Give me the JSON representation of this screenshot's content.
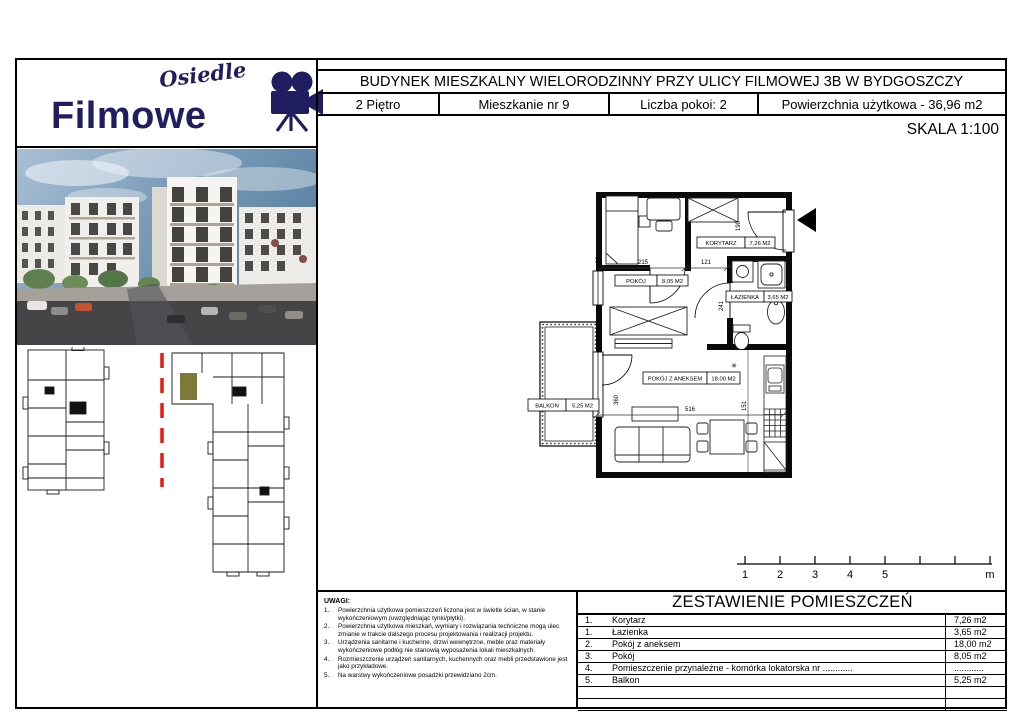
{
  "logo": {
    "top": "Osiedle",
    "bottom": "Filmowe"
  },
  "header": {
    "title": "BUDYNEK MIESZKALNY WIELORODZINNY PRZY ULICY FILMOWEJ 3B W BYDGOSZCZY",
    "floor": "2 Piętro",
    "apartment": "Mieszkanie nr 9",
    "rooms": "Liczba pokoi: 2",
    "area": "Powierzchnia użytkowa - 36,96 m2",
    "scale": "SKALA 1:100"
  },
  "floorplan": {
    "labels": {
      "korytarz": {
        "name": "KORYTARZ",
        "area": "7,26 M2"
      },
      "pokoj": {
        "name": "POKÓJ",
        "area": "8,05 M2"
      },
      "lazienka": {
        "name": "ŁAZIENKA",
        "area": "3,65 M2"
      },
      "aneks": {
        "name": "POKÓJ Z ANEKSEM",
        "area": "18,00 M2"
      },
      "balkon": {
        "name": "BALKON",
        "area": "5,25 M2"
      }
    },
    "dims": {
      "pokoj_w": "215",
      "korytarz_w": "121",
      "niche_h": "80",
      "wardrobe_h": "190",
      "bath_h": "241",
      "main_h": "360",
      "main_w": "516",
      "kitchen_h": "151"
    },
    "symbols": {
      "star": "✳"
    }
  },
  "scalebar": {
    "ticks": [
      "1",
      "2",
      "3",
      "4",
      "5"
    ],
    "unit": "m"
  },
  "notes": {
    "heading": "UWAGI:",
    "items": [
      {
        "num": "1.",
        "text": "Powierzchnia użytkowa pomieszczeń liczona jest w świetle ścian, w stanie wykończeniowym (uwzględniając tynki/płytki)."
      },
      {
        "num": "2.",
        "text": "Powierzchnia użytkowa mieszkań, wymiary i rozwiązania techniczne mogą ulec zmianie w trakcie dalszego procesu projektowania i realizacji projektu."
      },
      {
        "num": "3.",
        "text": "Urządzenia sanitarne i kuchenne, drzwi wewnętrzne, meble oraz materiały wykończeniowe podłóg nie stanowią wyposażenia lokali mieszkalnych."
      },
      {
        "num": "4.",
        "text": "Rozmieszczenie urządzeń sanitarnych, kuchennych oraz mebli przedstawione jest jako przykładowe."
      },
      {
        "num": "5.",
        "text": "Na warstwy wykończeniowe posadzki przewidziano 2cm."
      }
    ]
  },
  "room_table": {
    "title": "ZESTAWIENIE POMIESZCZEŃ",
    "rows": [
      {
        "num": "1.",
        "name": "Korytarz",
        "area": "7,26 m2"
      },
      {
        "num": "1.",
        "name": "Łazienka",
        "area": "3,65 m2"
      },
      {
        "num": "2.",
        "name": "Pokój z aneksem",
        "area": "18,00 m2"
      },
      {
        "num": "3.",
        "name": "Pokój",
        "area": "8,05 m2"
      },
      {
        "num": "4.",
        "name": "Pomieszczenie przynależne - komórka lokatorska nr ............",
        "area": "............"
      },
      {
        "num": "5.",
        "name": "Balkon",
        "area": "5,25 m2"
      }
    ]
  },
  "colors": {
    "logo_navy": "#201e5f",
    "highlight_olive": "#7c7a38",
    "red_dash": "#e51b15"
  }
}
